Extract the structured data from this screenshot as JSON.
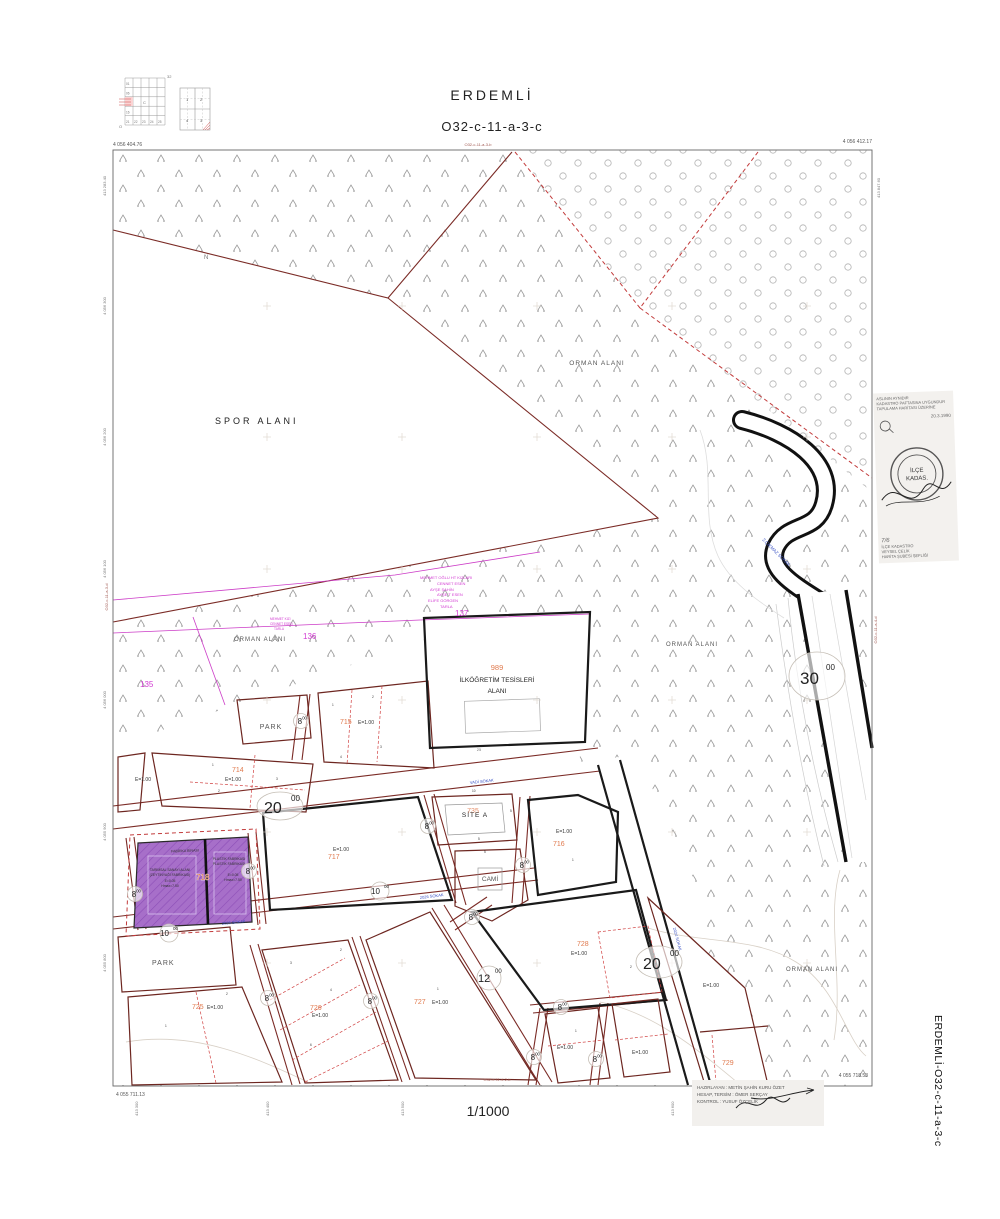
{
  "header": {
    "title": "ERDEMLİ",
    "sheet": "O32-c-11-a-3-c",
    "scale": "1/1000",
    "side_label": "ERDEMLİ-O32-c-11-a-3-c"
  },
  "neighbors": {
    "top": "O32-c-11-a-3-b",
    "bottom": "O32-c-11-d-2-b",
    "left": "O32-c-11-a-3-d",
    "right": "O32-c-11-a-4-d"
  },
  "corners": {
    "tl": "4 056 404.76",
    "tr": "4 056 412.17",
    "bl": "4 055 711.13",
    "br": "4 055 718.53",
    "tl_v": "413 283.40",
    "tr_v": "413 847.60"
  },
  "grid": {
    "northings": [
      "4 056 300",
      "4 056 200",
      "4 056 100",
      "4 056 000",
      "4 055 900",
      "4 055 800"
    ],
    "eastings": [
      "413 300",
      "413 400",
      "413 500",
      "413 600",
      "413 700",
      "413 800"
    ]
  },
  "index": {
    "corner": "32",
    "o": "O",
    "r1": "01",
    "r2": "06",
    "r3": "16",
    "center": "C",
    "b1": "21",
    "b2": "22",
    "b3": "23",
    "b4": "24",
    "b5": "25",
    "q1": "1",
    "q2": "2",
    "q3": "3",
    "q4": "4"
  },
  "zones": {
    "spor": "SPOR ALANI",
    "orman": "ORMAN ALANI",
    "park": "PARK",
    "cami": "CAMİ",
    "site_a": "SİTE A",
    "school_no": "989",
    "school_1": "İLKÖĞRETİM TESİSLERİ",
    "school_2": "ALANI",
    "north": "N",
    "dim25": "25"
  },
  "parcels": {
    "n135": "135",
    "n136": "136",
    "n137": "137",
    "n714": "714",
    "n715": "715",
    "n716": "716",
    "n717": "717",
    "n718": "718",
    "n725": "725",
    "n726": "726",
    "n727": "727",
    "n728": "728",
    "n729": "729",
    "n735": "735",
    "e": "E=1.00"
  },
  "roads": {
    "r30": "30",
    "r20": "20",
    "r12": "12",
    "r10": "10",
    "r8": "8",
    "sup": "00"
  },
  "streets": {
    "cikmaz": "2.ÇIKMAZ SOKAK",
    "vadi": "VADİ SOKAK",
    "s2026": "2026 SOKAK",
    "s2024": "2024 SOKAK"
  },
  "sanayi": {
    "l1": "TARIMSAL SANAYİ ALANI",
    "l2": "(ZEYTİNYAĞI FABRİKASI)",
    "l3": "E=0.05",
    "l4": "Hmax=7.50",
    "r1": "PLASTİK FABRİKASI",
    "r2": "PLASTİK FABRİKASI",
    "r3": "E=0.05",
    "r4": "Hmax=7.50",
    "ghost": "FABRİKA BİNASI"
  },
  "owners": {
    "l1": "MEHMET OĞLU HT KIZLARI",
    "l2": "CENNET ESEN",
    "l3": "AYŞE ŞAHİN",
    "l4": "AYŞE T ESEN",
    "l5": "ELİFE GÖRGEN",
    "l6": "TARLA",
    "s1": "MEHMET KIZI",
    "s2": "CENNET ESEN",
    "s3": "TARLA"
  },
  "lots": {
    "n1": "1",
    "n2": "2",
    "n3": "3",
    "n4": "4",
    "n5": "5",
    "n6": "6",
    "n10": "10"
  },
  "stamp": {
    "t1": "ASLININ AYNIDIR",
    "t2": "KADASTRO PAFTASINA UYGUNDUR",
    "t3": "TAPULAMA HARİTASI ÜZERİNE",
    "date": "20.3.1990",
    "seal1": "İLÇE",
    "seal2": "KADAS.",
    "b1": "İLÇE KADASTRO",
    "b2": "VEYSEL ÇELİK",
    "b3": "HARİTA ŞUBESİ ŞEFLİĞİ",
    "mark": "7/6"
  },
  "sig": {
    "r1": "HAZIRLAYAN : METİN ŞAHİN KURU ÖZET",
    "r2": "HESAP, TERSİM : ÖMER SERÇAY",
    "r3": "KONTROL : YUSUF ÖZÇELİK"
  }
}
